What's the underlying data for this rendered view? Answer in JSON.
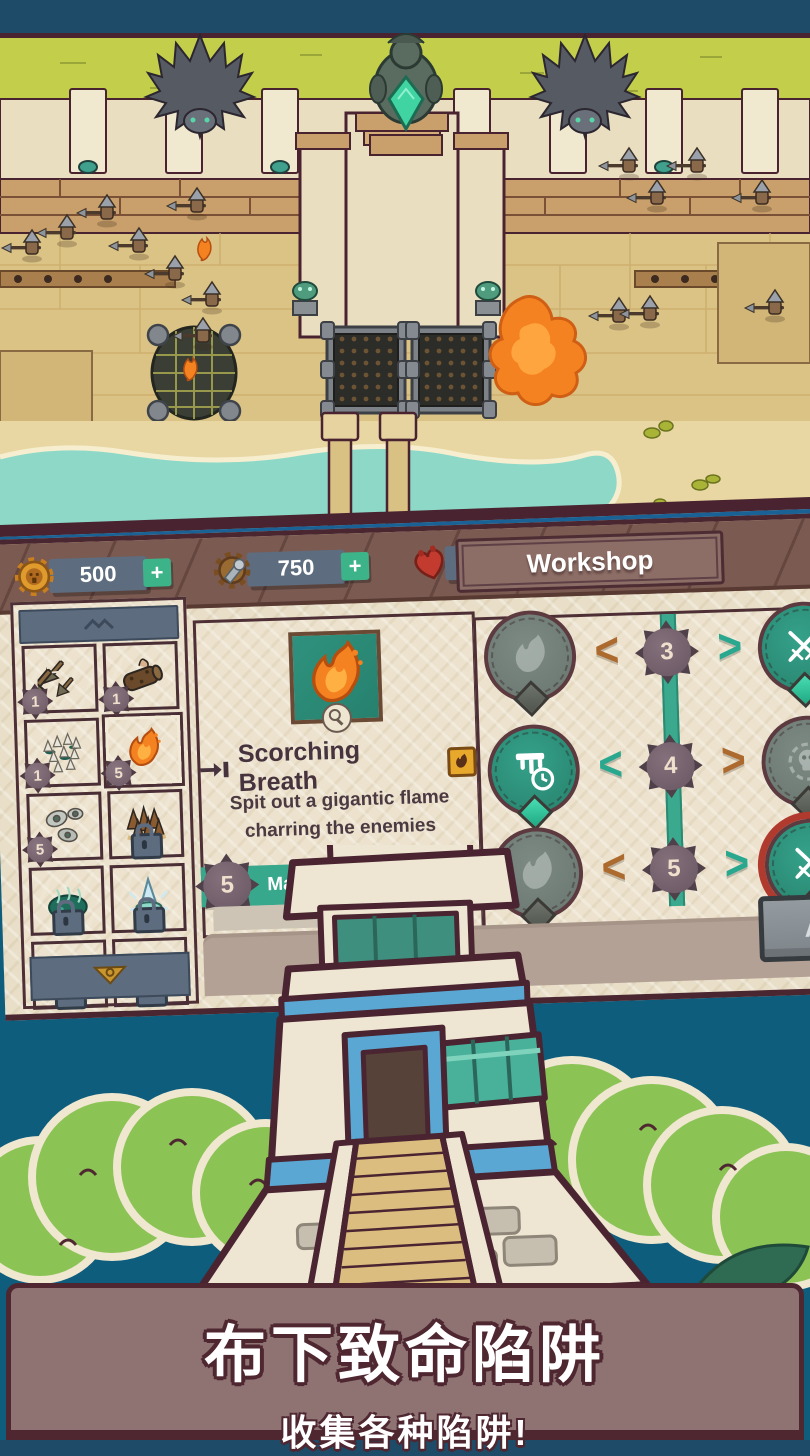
{
  "header": {
    "title": "Workshop",
    "currencies": [
      {
        "icon": "sun-medallion-icon",
        "value": "500",
        "add_label": "+"
      },
      {
        "icon": "gear-nail-icon",
        "value": "750",
        "add_label": "+"
      },
      {
        "icon": "heart-icon",
        "value": "1,500",
        "add_label": "+"
      }
    ]
  },
  "detail": {
    "item_name": "Scorching Breath",
    "element_badge": "fire",
    "description_line1": "Spit out a gigantic flame",
    "description_line2": "charring the enemies",
    "max_level_badge": "5",
    "max_level_text": "Max level reached"
  },
  "sidebar": {
    "items": [
      {
        "name": "darts-trap",
        "level": "1",
        "state": "unlocked"
      },
      {
        "name": "rolling-log-trap",
        "level": "1",
        "state": "unlocked"
      },
      {
        "name": "caltrops-trap",
        "level": "1",
        "state": "unlocked"
      },
      {
        "name": "fireball-trap",
        "level": "5",
        "state": "selected"
      },
      {
        "name": "boulder-trap",
        "level": "5",
        "state": "unlocked"
      },
      {
        "name": "spike-wall-trap",
        "state": "locked"
      },
      {
        "name": "poison-pool-trap",
        "state": "locked"
      },
      {
        "name": "geyser-trap",
        "state": "locked"
      },
      {
        "name": "fire-pit-trap",
        "state": "locked"
      },
      {
        "name": "bats-trap",
        "state": "locked"
      }
    ]
  },
  "tree": {
    "rows": [
      {
        "level": "3",
        "left_arrow": "<",
        "left_arrow_color": "orange",
        "left_icon": "flame",
        "left_state": "locked",
        "right_arrow": ">",
        "right_arrow_color": "teal",
        "right_icon": "crossed-swords",
        "right_state": "unlocked"
      },
      {
        "level": "4",
        "left_arrow": "<",
        "left_arrow_color": "teal",
        "left_icon": "drip-clock",
        "left_state": "unlocked",
        "right_arrow": ">",
        "right_arrow_color": "orange",
        "right_icon": "skull",
        "right_state": "locked"
      },
      {
        "level": "5",
        "left_arrow": "<",
        "left_arrow_color": "orange",
        "left_icon": "flame",
        "left_state": "locked",
        "right_arrow": ">",
        "right_arrow_color": "teal",
        "right_icon": "crossed-swords",
        "right_state": "selected"
      }
    ]
  },
  "footer": {
    "info_text": "Inflict twice the",
    "activate_label": "Activate"
  },
  "caption": {
    "title": "布下致命陷阱",
    "subtitle": "收集各种陷阱!"
  },
  "colors": {
    "accent_teal": "#38a88c",
    "tile_teal": "#2f927e",
    "wood_brown": "#7b5b51",
    "cream": "#e9dfc8",
    "maroon_outline": "#4f2731",
    "slate": "#5d6c7e",
    "plus_green": "#3db389",
    "flame_orange": "#f58220",
    "selected_ring_red": "#b03a2d",
    "water_turquoise": "#8ed8c8",
    "background_blue": "#0e5d7d"
  }
}
